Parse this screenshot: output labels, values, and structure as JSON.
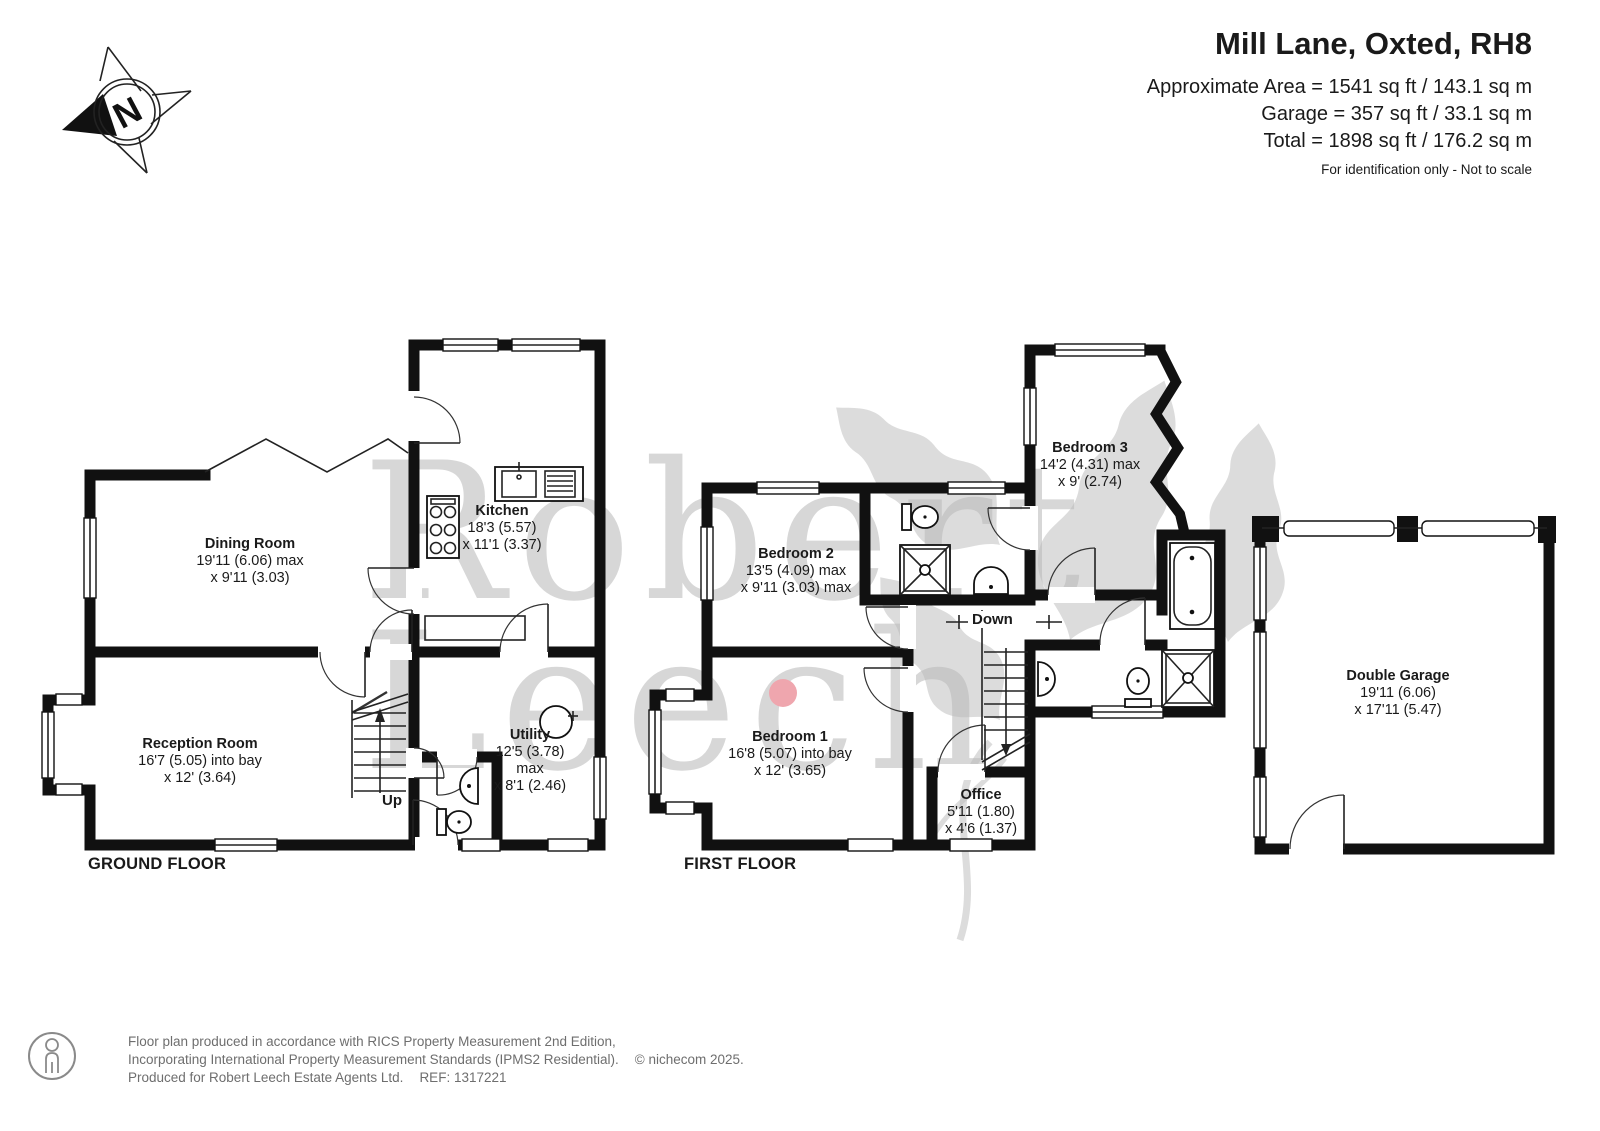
{
  "header": {
    "title": "Mill Lane, Oxted, RH8",
    "area_line1": "Approximate Area = 1541 sq ft / 143.1 sq m",
    "area_line2": "Garage = 357 sq ft / 33.1 sq m",
    "area_line3": "Total = 1898 sq ft / 176.2 sq m",
    "note": "For identification only - Not to scale"
  },
  "compass": {
    "north_label": "N"
  },
  "watermark": {
    "word1": "Robert",
    "word2": "Leech"
  },
  "ground_floor": {
    "label": "GROUND FLOOR",
    "stairs_label": "Up",
    "rooms": {
      "dining": {
        "name": "Dining Room",
        "dim1": "19'11 (6.06) max",
        "dim2": "x 9'11 (3.03)"
      },
      "kitchen": {
        "name": "Kitchen",
        "dim1": "18'3 (5.57)",
        "dim2": "x 11'1 (3.37)"
      },
      "reception": {
        "name": "Reception Room",
        "dim1": "16'7 (5.05) into bay",
        "dim2": "x 12' (3.64)"
      },
      "utility": {
        "name": "Utility",
        "dim1": "12'5 (3.78)",
        "dim2": "max",
        "dim3": "x 8'1 (2.46)"
      }
    }
  },
  "first_floor": {
    "label": "FIRST FLOOR",
    "stairs_label": "Down",
    "rooms": {
      "bedroom1": {
        "name": "Bedroom 1",
        "dim1": "16'8 (5.07) into bay",
        "dim2": "x 12' (3.65)"
      },
      "bedroom2": {
        "name": "Bedroom 2",
        "dim1": "13'5 (4.09) max",
        "dim2": "x 9'11 (3.03) max"
      },
      "bedroom3": {
        "name": "Bedroom 3",
        "dim1": "14'2 (4.31) max",
        "dim2": "x 9' (2.74)"
      },
      "office": {
        "name": "Office",
        "dim1": "5'11 (1.80)",
        "dim2": "x 4'6 (1.37)"
      }
    }
  },
  "garage": {
    "rooms": {
      "double_garage": {
        "name": "Double Garage",
        "dim1": "19'11 (6.06)",
        "dim2": "x 17'11 (5.47)"
      }
    }
  },
  "footer": {
    "line1": "Floor plan produced in accordance with RICS Property Measurement 2nd Edition,",
    "line2": "Incorporating International Property Measurement Standards (IPMS2 Residential).",
    "line2_suffix": "© nichecom 2025.",
    "line3": "Produced for Robert Leech Estate Agents Ltd.",
    "line3_suffix": "REF: 1317221"
  },
  "colors": {
    "wall": "#111111",
    "text": "#1a1a1a",
    "watermark_grey": "#a8a8a8",
    "accent_dot": "#efa6ae",
    "footer_text": "#6e6e6e"
  }
}
